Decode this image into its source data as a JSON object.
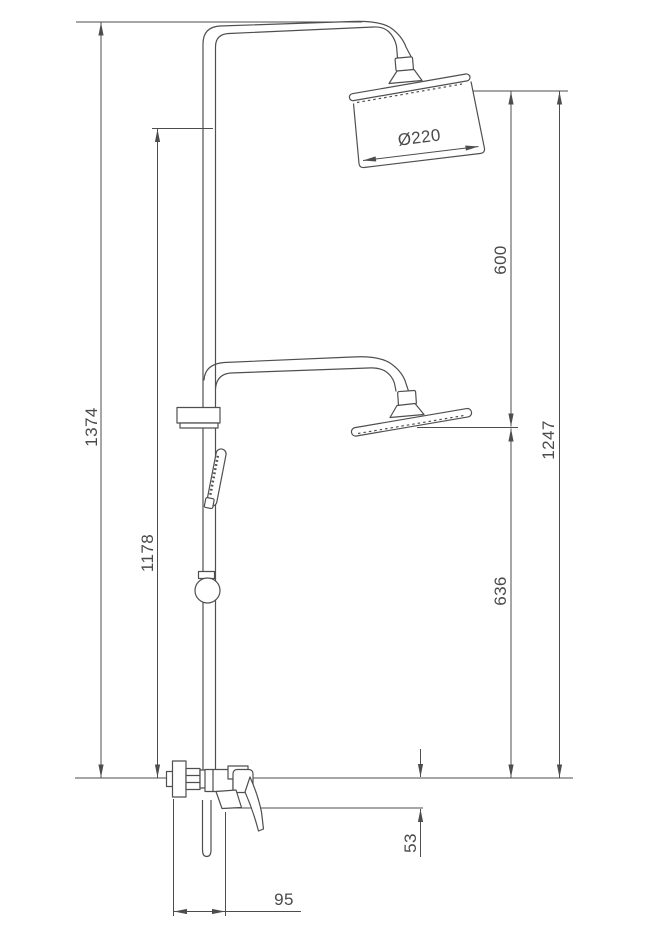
{
  "drawing": {
    "type": "technical dimension drawing",
    "subject": "shower column with two overhead shower positions, hand shower and wall mixer",
    "units": "mm",
    "line_color": "#4d4d4d",
    "background": "#ffffff",
    "dimension_labels": {
      "overall_height": "1374",
      "riser_rail_height": "1178",
      "between_head_levels": "600",
      "upper_head_above_base": "1247",
      "lower_head_above_base": "636",
      "handle_below_base": "53",
      "mixer_projection": "95",
      "shower_head_diameter": "Ø220"
    }
  }
}
